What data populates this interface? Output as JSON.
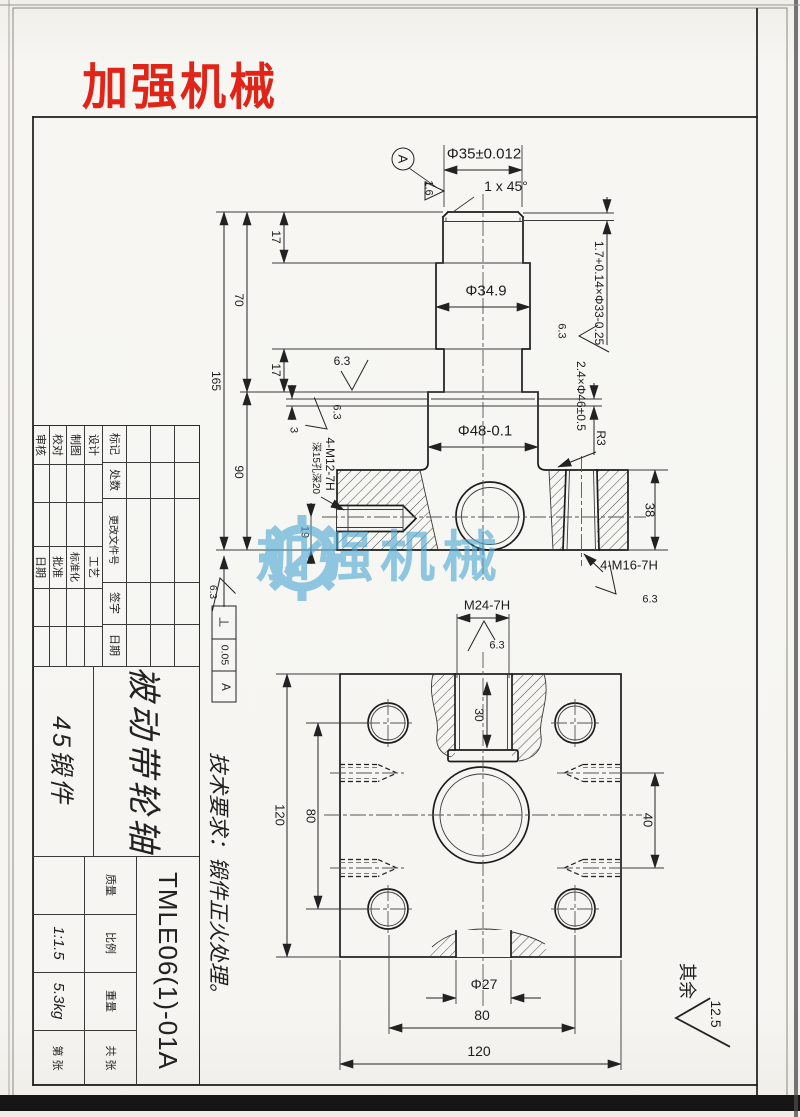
{
  "logo": {
    "text": "加强机械",
    "color": "#e02417"
  },
  "watermark": {
    "text": "加强机械",
    "color": "#4fa9d6",
    "icon": "gear-icon"
  },
  "colors": {
    "paper": "#f6f5f1",
    "line": "#1c1c1c",
    "logo_red": "#e02417",
    "watermark_blue": "#4fa9d6"
  },
  "title_block": {
    "mark": "标记",
    "count": "处数",
    "change_doc": "更改文件号",
    "sign": "签字",
    "date": "日期",
    "design": "设计",
    "draft": "制图",
    "check": "校对",
    "review": "审核",
    "process": "工艺",
    "standardize": "标准化",
    "approve": "批准",
    "date2": "日期",
    "part_name": "被动带轮轴",
    "material": "45锻件",
    "drawing_no": "TMLE06(1)-01A",
    "mass": "质量",
    "scale": "比例",
    "weight": "重量",
    "scale_value": "1:1.5",
    "weight_value": "5.3kg",
    "sheet_total": "共 张",
    "sheet_no": "第 张"
  },
  "labels": [
    {
      "name": "dim-phi35",
      "t": "Φ35±0.012",
      "x": 484,
      "y": 154,
      "r": 0,
      "s": 15
    },
    {
      "name": "chamfer-note",
      "t": "1 x 45°",
      "x": 506,
      "y": 186,
      "r": 0,
      "s": 14
    },
    {
      "name": "datum-label",
      "t": "A",
      "x": 403,
      "y": 159,
      "r": 90,
      "s": 13
    },
    {
      "name": "roughness-datum",
      "t": "1.6",
      "x": 428,
      "y": 188,
      "r": 90,
      "s": 11
    },
    {
      "name": "groove-top-note",
      "t": "1.7+0.14×Φ33-0.25",
      "x": 599,
      "y": 293,
      "r": 90,
      "s": 12
    },
    {
      "name": "dim-phi34-9",
      "t": "Φ34.9",
      "x": 486,
      "y": 291,
      "r": 0,
      "s": 15
    },
    {
      "name": "roughness-neck",
      "t": "6.3",
      "x": 342,
      "y": 361,
      "r": 0,
      "s": 12
    },
    {
      "name": "groove-collar-note",
      "t": "2.4×Φ46±0.5",
      "x": 581,
      "y": 396,
      "r": 90,
      "s": 12
    },
    {
      "name": "roughness-collar",
      "t": "6.3",
      "x": 561,
      "y": 331,
      "r": 90,
      "s": 11
    },
    {
      "name": "dim-phi48",
      "t": "Φ48-0.1",
      "x": 485,
      "y": 431,
      "r": 0,
      "s": 15
    },
    {
      "name": "radius-note",
      "t": "R3",
      "x": 601,
      "y": 438,
      "r": 90,
      "s": 12
    },
    {
      "name": "dim-38",
      "t": "38",
      "x": 650,
      "y": 510,
      "r": 90,
      "s": 13
    },
    {
      "name": "thread-note-m16",
      "t": "4-M16-7H",
      "x": 629,
      "y": 565,
      "r": 0,
      "s": 13
    },
    {
      "name": "roughness-m16",
      "t": "6.3",
      "x": 650,
      "y": 600,
      "r": 0,
      "s": 11
    },
    {
      "name": "thread-note-m24",
      "t": "M24-7H",
      "x": 487,
      "y": 605,
      "r": 0,
      "s": 13
    },
    {
      "name": "roughness-m24",
      "t": "6.3",
      "x": 497,
      "y": 646,
      "r": 0,
      "s": 11
    },
    {
      "name": "dim-17-top",
      "t": "17",
      "x": 276,
      "y": 237,
      "r": 90,
      "s": 12
    },
    {
      "name": "dim-70",
      "t": "70",
      "x": 239,
      "y": 300,
      "r": 90,
      "s": 12
    },
    {
      "name": "dim-165",
      "t": "165",
      "x": 216,
      "y": 381,
      "r": 90,
      "s": 12
    },
    {
      "name": "dim-90",
      "t": "90",
      "x": 239,
      "y": 472,
      "r": 90,
      "s": 12
    },
    {
      "name": "dim-17-mid",
      "t": "17",
      "x": 276,
      "y": 370,
      "r": 90,
      "s": 12
    },
    {
      "name": "dim-3",
      "t": "3",
      "x": 293,
      "y": 430,
      "r": 90,
      "s": 11
    },
    {
      "name": "thread-note-m12",
      "t": "4-M12-7H",
      "x": 330,
      "y": 464,
      "r": 90,
      "s": 12
    },
    {
      "name": "depth-note-m12",
      "t": "深15孔深20",
      "x": 315,
      "y": 468,
      "r": 90,
      "s": 10
    },
    {
      "name": "roughness-m12",
      "t": "6.3",
      "x": 336,
      "y": 412,
      "r": 90,
      "s": 11
    },
    {
      "name": "dim-19",
      "t": "19",
      "x": 304,
      "y": 532,
      "r": 90,
      "s": 11
    },
    {
      "name": "roughness-bottom-left",
      "t": "6.3",
      "x": 212,
      "y": 592,
      "r": 90,
      "s": 10
    },
    {
      "name": "tolerance-symbol",
      "t": "⊥",
      "x": 224,
      "y": 622,
      "r": 90,
      "s": 13
    },
    {
      "name": "tolerance-value",
      "t": "0.05",
      "x": 224,
      "y": 655,
      "r": 90,
      "s": 10.5
    },
    {
      "name": "tolerance-datum",
      "t": "A",
      "x": 224,
      "y": 687,
      "r": 90,
      "s": 11.5
    },
    {
      "name": "dim-30",
      "t": "30",
      "x": 479,
      "y": 715,
      "r": 90,
      "s": 12
    },
    {
      "name": "dim-120-left",
      "t": "120",
      "x": 280,
      "y": 815,
      "r": 90,
      "s": 13
    },
    {
      "name": "dim-80-left",
      "t": "80",
      "x": 311,
      "y": 816,
      "r": 90,
      "s": 13
    },
    {
      "name": "dim-40",
      "t": "40",
      "x": 648,
      "y": 820,
      "r": 90,
      "s": 13
    },
    {
      "name": "dim-phi27",
      "t": "Φ27",
      "x": 484,
      "y": 984,
      "r": 0,
      "s": 14
    },
    {
      "name": "dim-80-bottom",
      "t": "80",
      "x": 482,
      "y": 1015,
      "r": 0,
      "s": 14
    },
    {
      "name": "dim-120-bottom",
      "t": "120",
      "x": 479,
      "y": 1051,
      "r": 0,
      "s": 14
    },
    {
      "name": "remainder-label",
      "t": "其余",
      "x": 687,
      "y": 981,
      "r": 90,
      "s": 18
    },
    {
      "name": "roughness-remainder",
      "t": "12.5",
      "x": 716,
      "y": 1014,
      "r": 90,
      "s": 14
    },
    {
      "name": "tech-requirements",
      "t": "技术要求：锻件正火处理。",
      "x": 218,
      "y": 878,
      "r": 90,
      "s": 21,
      "i": 1
    }
  ]
}
